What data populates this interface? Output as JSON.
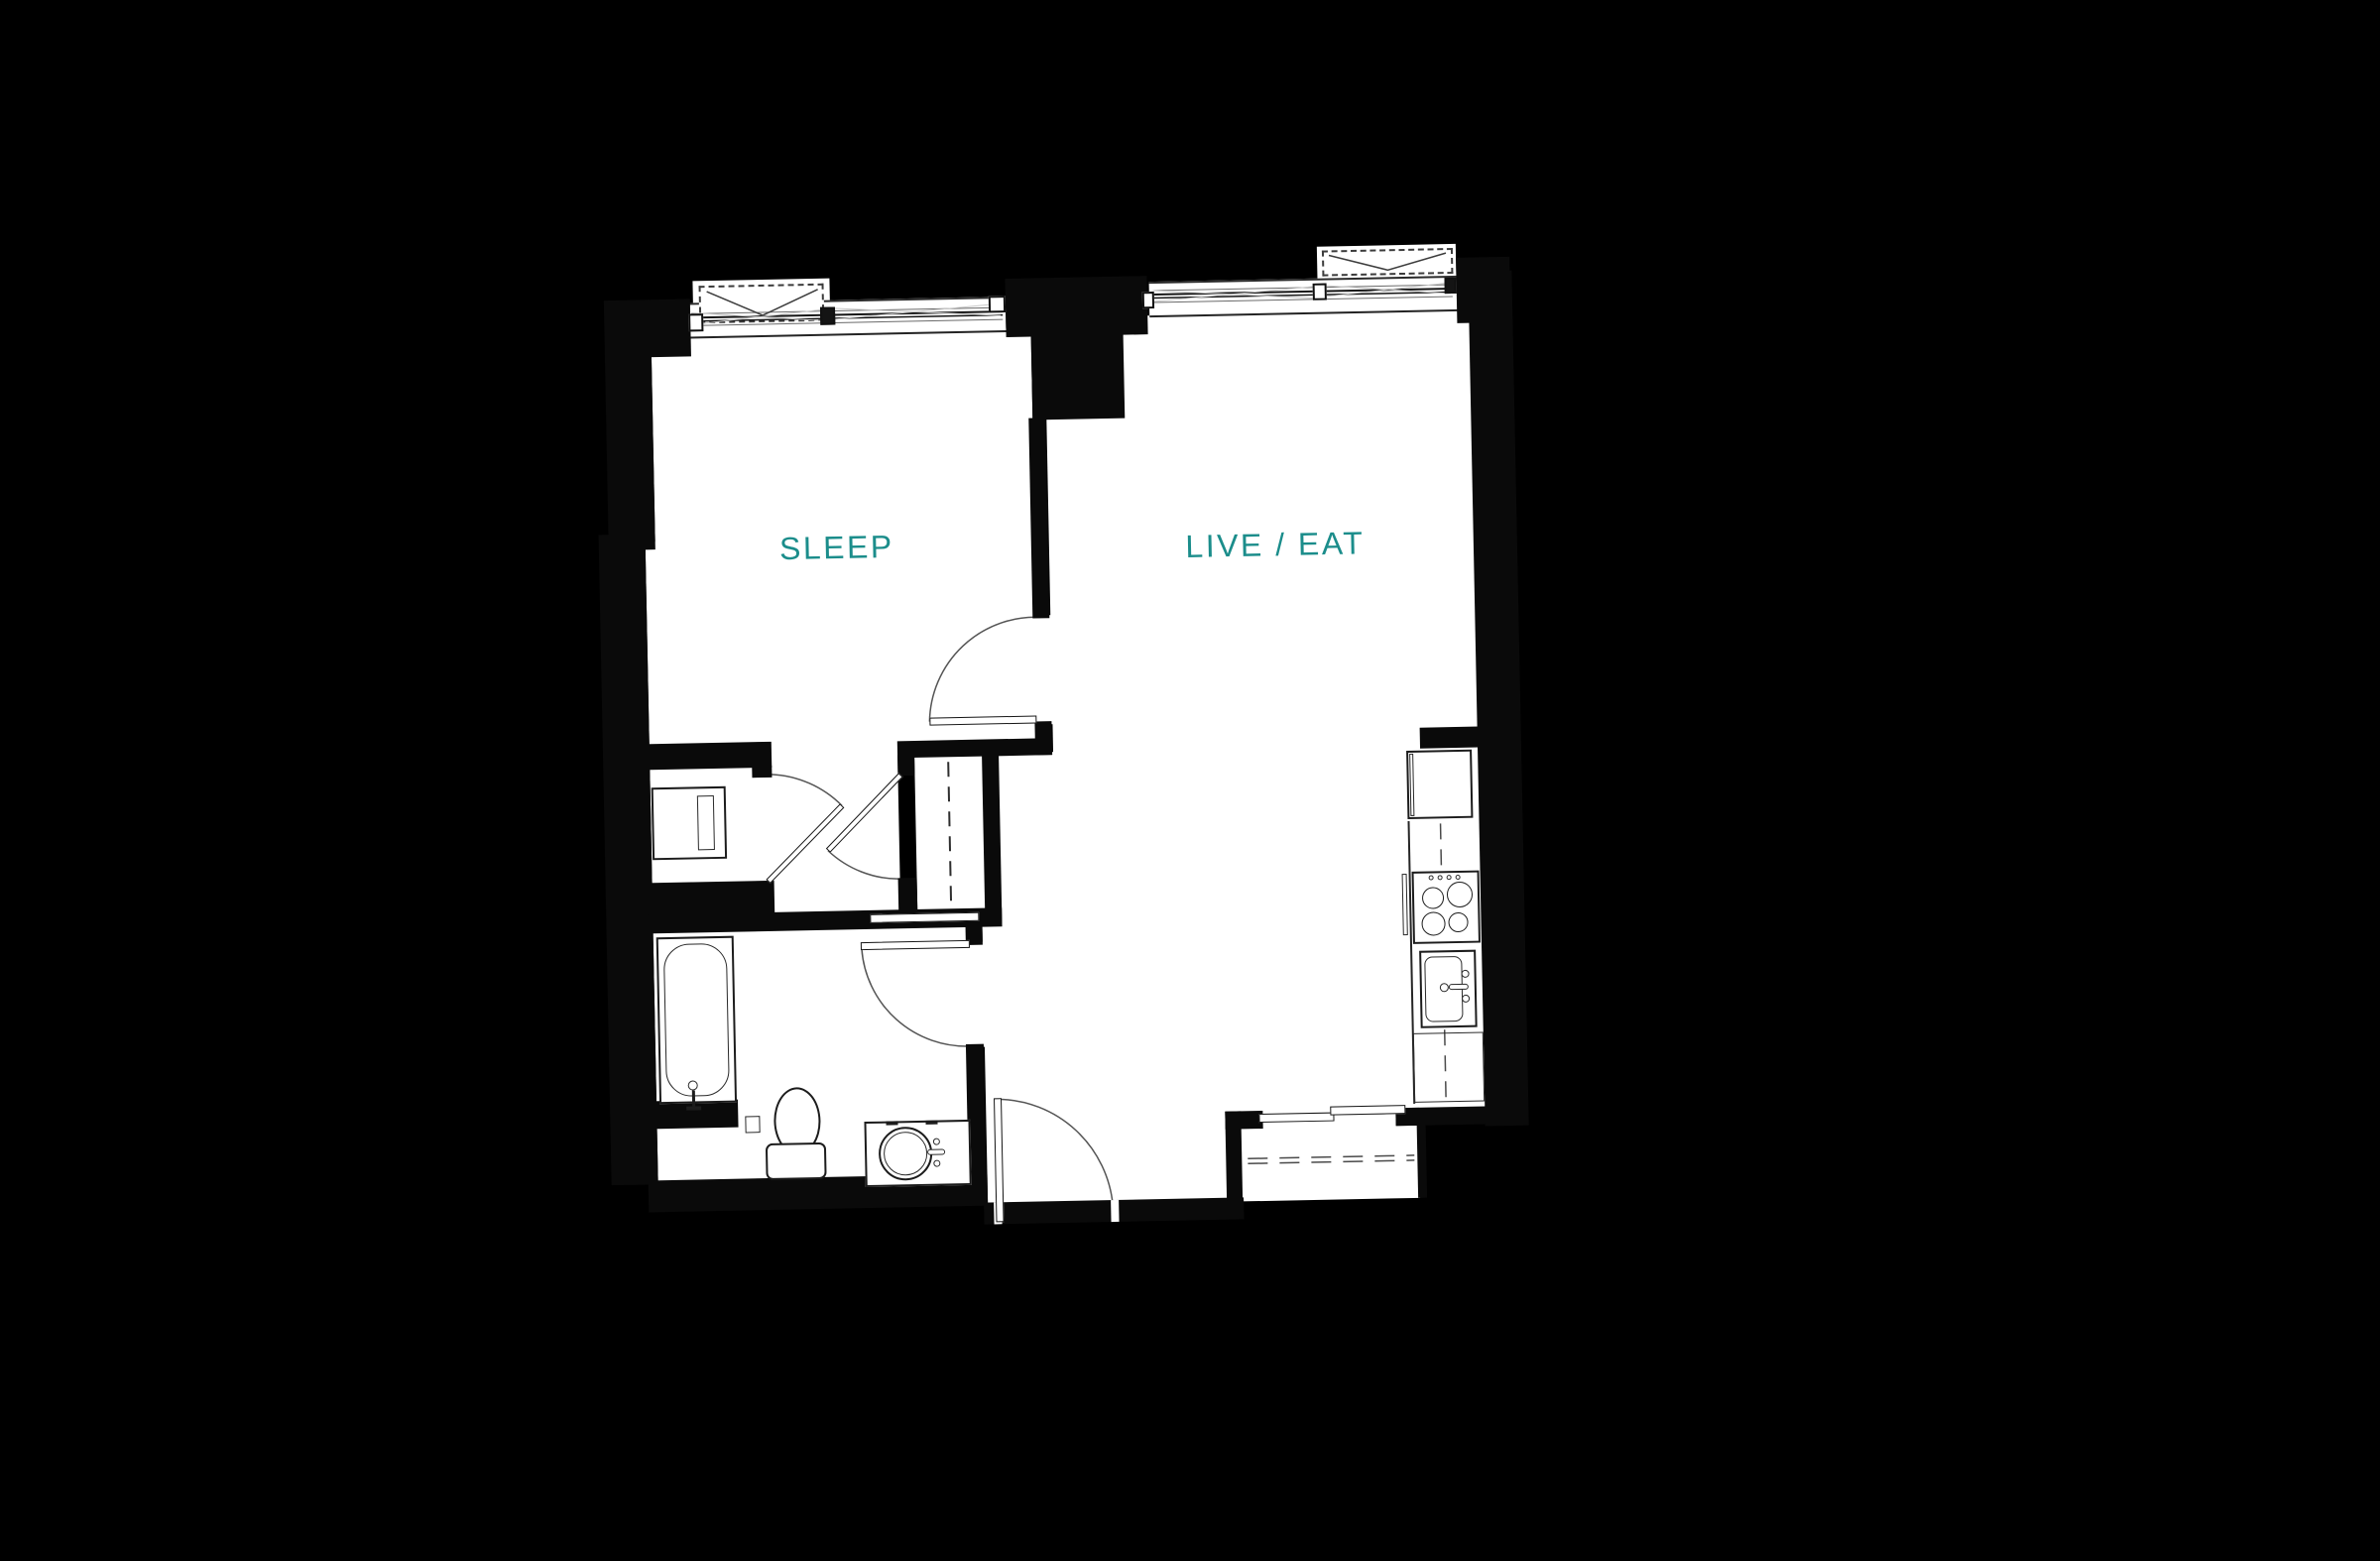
{
  "floorplan": {
    "rooms": {
      "sleep": {
        "label": "SLEEP"
      },
      "live_eat": {
        "label": "LIVE / EAT"
      }
    },
    "colors": {
      "background": "#000000",
      "floor": "#ffffff",
      "walls": "#0a0a0a",
      "linework": "#222222",
      "room_label_teal": "#1b8d8b"
    },
    "fixtures": [
      "washer-dryer",
      "bathtub",
      "tub-faucet",
      "toilet",
      "vanity-sink",
      "bedroom-closet-rod",
      "coat-closet-shelf",
      "refrigerator",
      "range",
      "kitchen-sink",
      "dishwasher",
      "entry-door",
      "bedroom-door",
      "bathroom-door",
      "closet-doors",
      "windows"
    ]
  }
}
